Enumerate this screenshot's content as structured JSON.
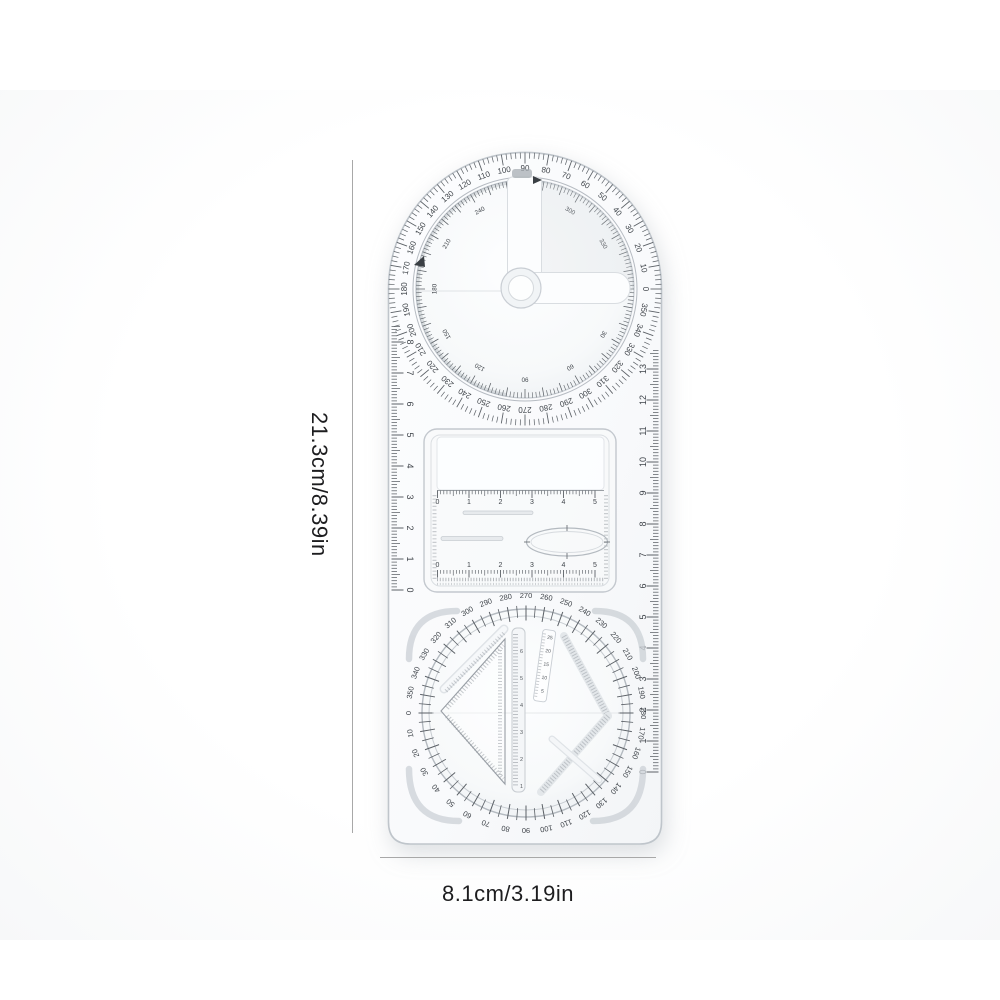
{
  "annotations": {
    "height_label": "21.3cm/8.39in",
    "width_label": "8.1cm/3.19in"
  },
  "top_dial": {
    "outer_labels_cw_from_top": [
      "90",
      "80",
      "70",
      "60",
      "50",
      "40",
      "30",
      "20",
      "10",
      "0",
      "350",
      "340",
      "330",
      "320",
      "310",
      "300",
      "290",
      "280",
      "270",
      "260",
      "250",
      "240",
      "230",
      "220",
      "210",
      "200",
      "190",
      "180",
      "170",
      "160",
      "150",
      "140",
      "130",
      "120",
      "110",
      "100"
    ],
    "inner_labels_cw_from_top": [
      "270",
      "300",
      "330",
      "0",
      "30",
      "60",
      "90",
      "120",
      "150",
      "180",
      "210",
      "240"
    ]
  },
  "bottom_dial": {
    "labels_cw_from_top": [
      "270",
      "260",
      "250",
      "240",
      "230",
      "220",
      "210",
      "200",
      "190",
      "180",
      "170",
      "160",
      "150",
      "140",
      "130",
      "120",
      "110",
      "100",
      "90",
      "80",
      "70",
      "60",
      "50",
      "40",
      "30",
      "20",
      "10",
      "0",
      "350",
      "340",
      "330",
      "320",
      "310",
      "300",
      "290",
      "280"
    ]
  },
  "edge_rulers": {
    "left_numbers": [
      "0",
      "1",
      "2",
      "3",
      "4",
      "5",
      "6",
      "7",
      "8"
    ],
    "right_numbers": [
      "0",
      "1",
      "2",
      "3",
      "4",
      "5",
      "6",
      "7",
      "8",
      "9",
      "10",
      "11",
      "12",
      "13"
    ]
  },
  "window_scales": {
    "top_numbers": [
      "0",
      "1",
      "2",
      "3",
      "4",
      "5"
    ],
    "bottom_numbers": [
      "0",
      "1",
      "2",
      "3",
      "4",
      "5"
    ]
  },
  "bottom_disc": {
    "central_ruler_numbers": [
      "6",
      "5",
      "4",
      "3",
      "2",
      "1"
    ],
    "mini_scale_numbers": [
      "25",
      "20",
      "15",
      "10",
      "5"
    ]
  },
  "colors": {
    "tick": "#5b6066",
    "label": "#3f444a",
    "edge": "#c2c7cd",
    "dimension_line": "#a8a8a8"
  }
}
